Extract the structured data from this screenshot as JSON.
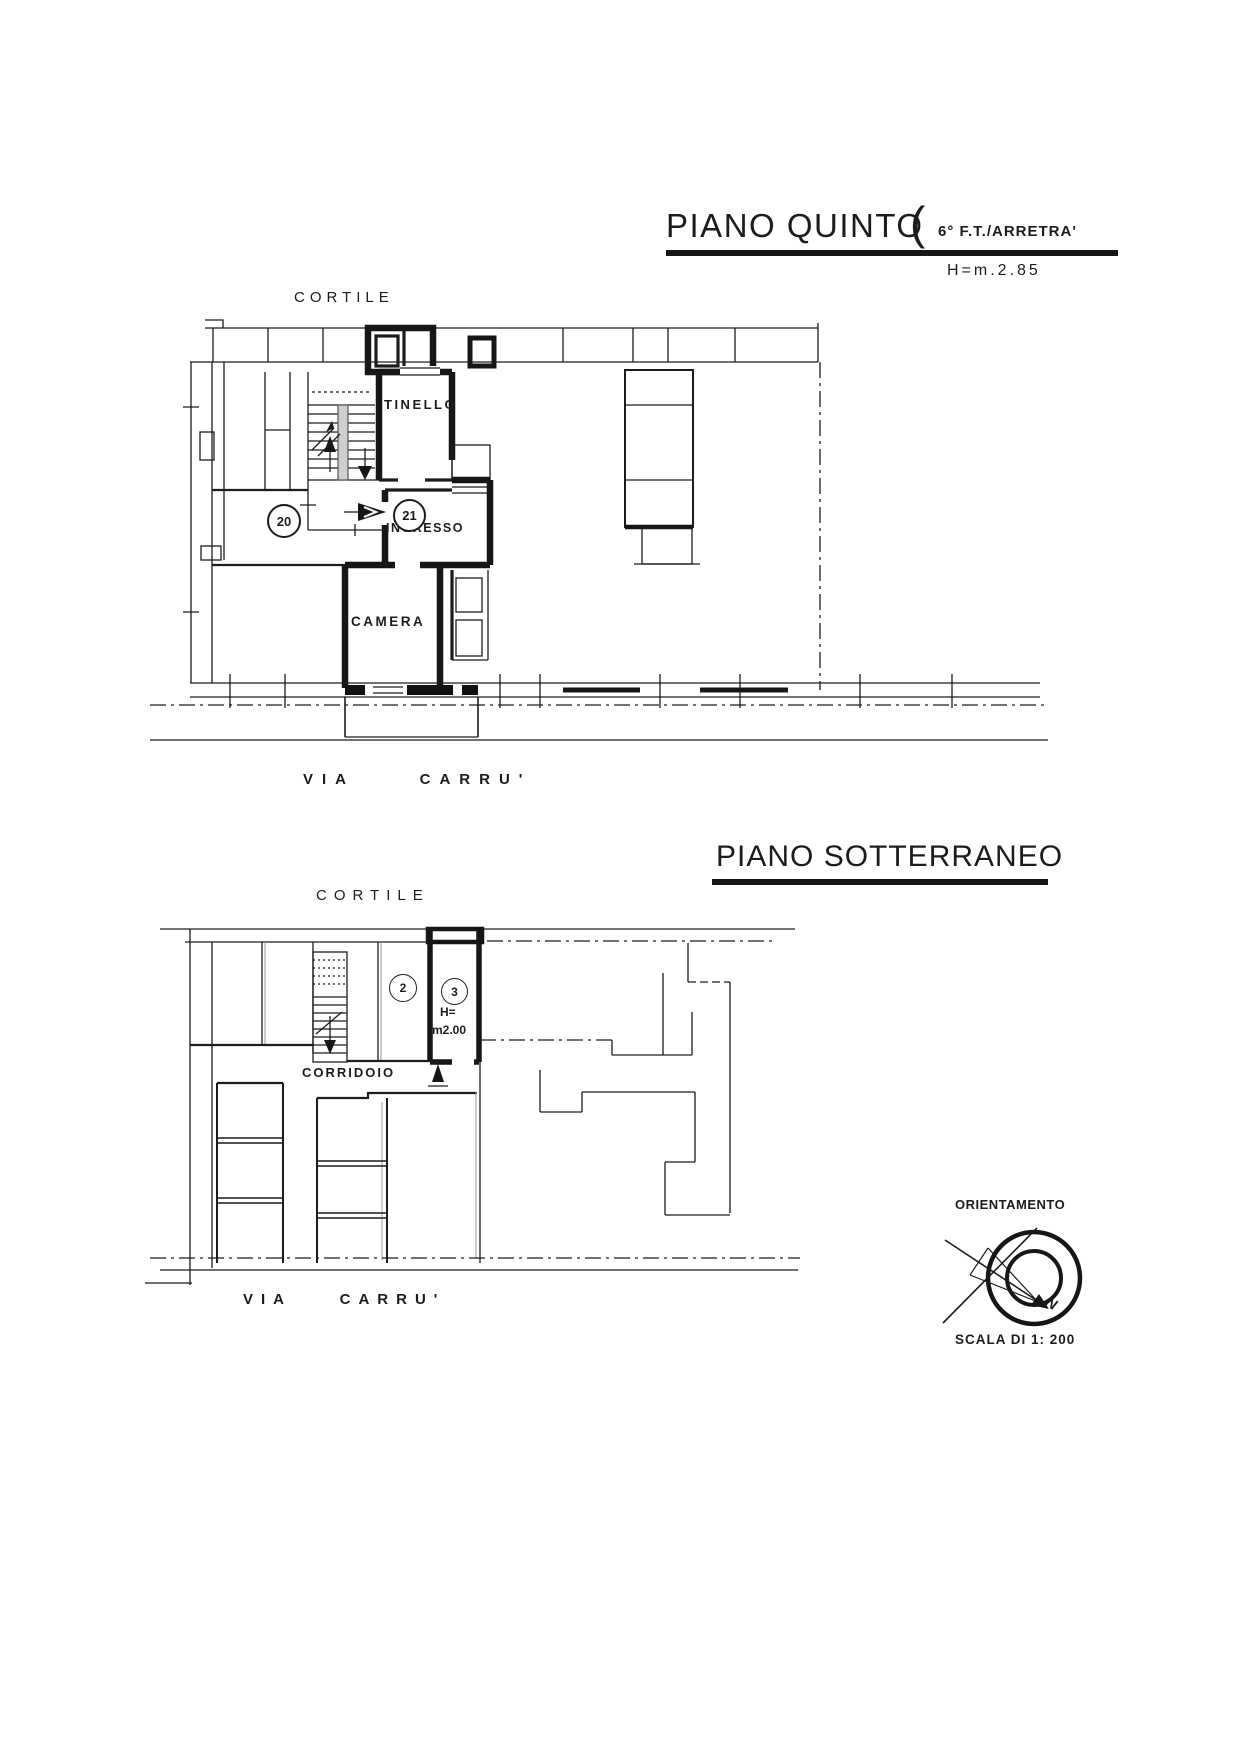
{
  "upper": {
    "title": "PIANO QUINTO",
    "paren": "(",
    "annex": "6° F.T./ARRETRA'",
    "height_note": "H=m.2.85",
    "courtyard": "CORTILE",
    "street": "VIA CARRU'",
    "room_tinello": "TINELLO",
    "room_ingresso": "INGRESSO",
    "room_camera": "CAMERA",
    "unit_left": "20",
    "unit_right": "21"
  },
  "lower": {
    "title": "PIANO SOTTERRANEO",
    "courtyard": "CORTILE",
    "corridor": "CORRIDOIO",
    "street": "VIA CARRU'",
    "cellar_left": "2",
    "cellar_right": "3",
    "height_line1": "H=",
    "height_line2": "m2.00"
  },
  "legend": {
    "orientation": "ORIENTAMENTO",
    "scale": "SCALA DI 1: 200",
    "north": "N"
  },
  "colors": {
    "ink": "#1c1c1c",
    "paper": "#ffffff"
  }
}
